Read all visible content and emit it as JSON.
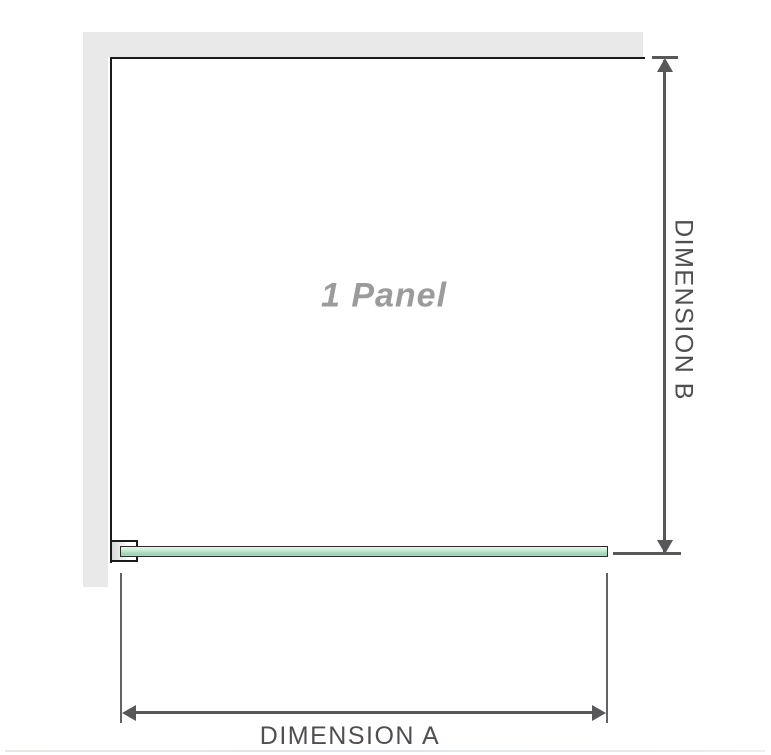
{
  "diagram": {
    "panel_label": "1 Panel",
    "dimensions": {
      "a_label": "DIMENSION A",
      "b_label": "DIMENSION B"
    },
    "colors": {
      "wall_band": "#e9e9e9",
      "panel_outline": "#1b1b1b",
      "glass_green_light": "#e4f6ea",
      "glass_green_dark": "#97d4b2",
      "dimension_line": "#58585a",
      "panel_label_text": "#9b9b9b",
      "dimension_label_text": "#4f4f51"
    },
    "icons": {
      "arrow_up": "triangle pointing up",
      "arrow_down": "triangle pointing down",
      "arrow_left": "triangle pointing left",
      "arrow_right": "triangle pointing right"
    }
  }
}
